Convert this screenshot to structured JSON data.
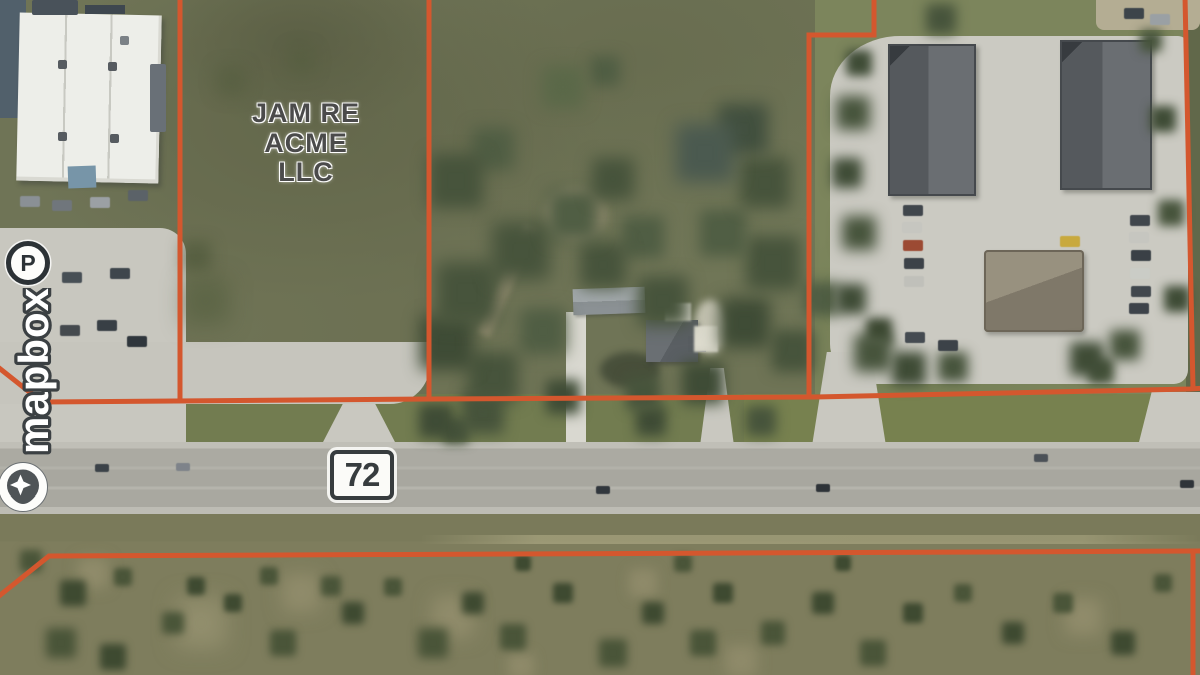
{
  "map": {
    "parcel_label": [
      "JAM RE",
      "ACME",
      "LLC"
    ],
    "road_shield": "72",
    "attribution_wordmark": "mapbox",
    "parking_marker": "P"
  },
  "colors": {
    "parcel-line": "#d4572e",
    "parcel-label": "#4b4b4b",
    "shield": "#373c3e",
    "logo-outline": "#3b4043",
    "logo-fill": "#ffffff"
  }
}
